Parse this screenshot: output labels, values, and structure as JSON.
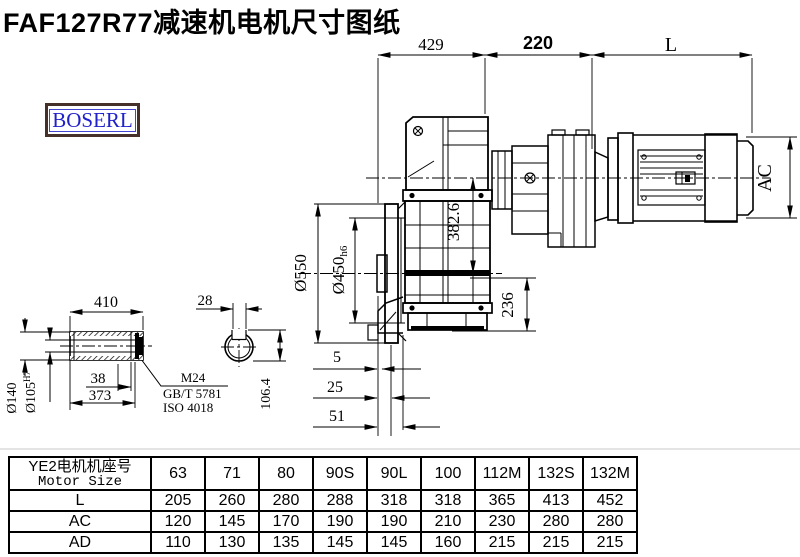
{
  "title": "FAF127R77减速机电机尺寸图纸",
  "brand": "BOSERL",
  "dims": {
    "top_429": "429",
    "top_220": "220",
    "top_L": "L",
    "ac": "AC",
    "axis_382": "382.6",
    "height_236": "236",
    "flange_od": "Ø550",
    "spigot_main": "Ø450",
    "spigot_tol": "h6",
    "gap_5": "5",
    "gap_25": "25",
    "gap_51": "51",
    "shaft_len": "410",
    "shaft_38": "38",
    "shaft_373": "373",
    "shaft_od_main": "Ø140",
    "bore_main": "Ø105",
    "bore_tol": "H7",
    "key_w": "28",
    "key_h": "106.4",
    "leader_1": "M24",
    "leader_2": "GB/T 5781",
    "leader_3": "ISO 4018"
  },
  "table": {
    "header_zh": "YE2电机机座号",
    "header_en": "Motor Size",
    "columns": [
      "63",
      "71",
      "80",
      "90S",
      "90L",
      "100",
      "112M",
      "132S",
      "132M"
    ],
    "rows": [
      {
        "label": "L",
        "values": [
          "205",
          "260",
          "280",
          "288",
          "318",
          "318",
          "365",
          "413",
          "452"
        ]
      },
      {
        "label": "AC",
        "values": [
          "120",
          "145",
          "170",
          "190",
          "190",
          "210",
          "230",
          "280",
          "280"
        ]
      },
      {
        "label": "AD",
        "values": [
          "110",
          "130",
          "135",
          "145",
          "145",
          "160",
          "215",
          "215",
          "215"
        ]
      }
    ]
  },
  "colors": {
    "line": "#000000",
    "brand_text": "#2020cc",
    "brand_border": "#46302a"
  }
}
